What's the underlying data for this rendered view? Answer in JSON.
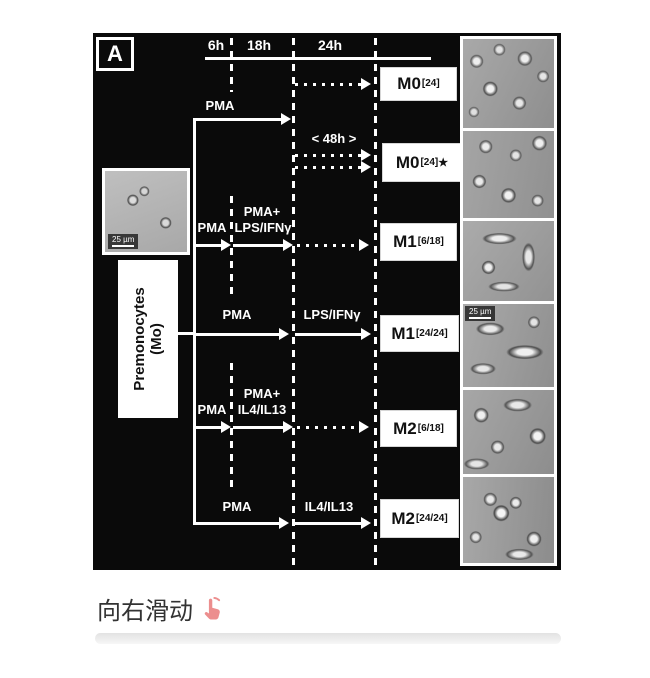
{
  "figure": {
    "panel_label": "A",
    "timeline_ticks": [
      "6h",
      "18h",
      "24h"
    ],
    "source_box": {
      "line1": "Premonocytes",
      "line2": "(Mo)"
    },
    "scale_bar_label": "25 µm",
    "rows": [
      {
        "id": "m0-24",
        "pma": "PMA",
        "result": "M0",
        "sup": "[24]",
        "star": ""
      },
      {
        "id": "m0-24-star",
        "note": "< 48h >",
        "result": "M0",
        "sup": "[24]",
        "star": "★"
      },
      {
        "id": "m1-6-18",
        "pma": "PMA",
        "prime": "PMA+",
        "stim": "LPS/IFNγ",
        "result": "M1",
        "sup": "[6/18]",
        "star": ""
      },
      {
        "id": "m1-24-24",
        "pma": "PMA",
        "stim": "LPS/IFNγ",
        "result": "M1",
        "sup": "[24/24]",
        "star": ""
      },
      {
        "id": "m2-6-18",
        "pma": "PMA",
        "prime": "PMA+",
        "stim": "IL4/IL13",
        "result": "M2",
        "sup": "[6/18]",
        "star": ""
      },
      {
        "id": "m2-24-24",
        "pma": "PMA",
        "stim": "IL4/IL13",
        "result": "M2",
        "sup": "[24/24]",
        "star": ""
      }
    ]
  },
  "caption": {
    "text": "向右滑动"
  },
  "icons": {
    "swipe_hint": "pointing-up-finger-icon"
  },
  "colors": {
    "figure_background": "#0a0a0a",
    "figure_foreground": "#ffffff",
    "caption_text": "#333333",
    "swipe_finger": "#ec8e8e",
    "next_card_edge": "#e2e2e2"
  }
}
